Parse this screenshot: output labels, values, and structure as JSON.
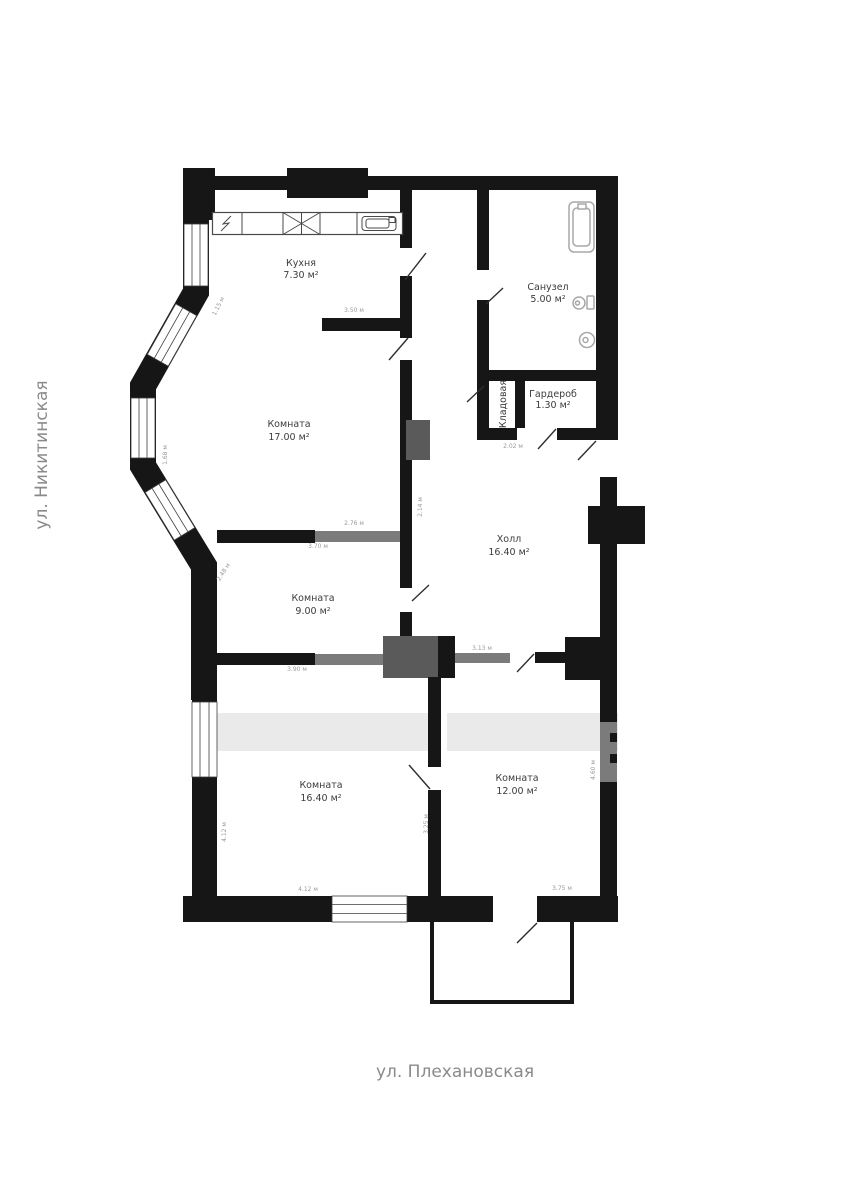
{
  "plan": {
    "streets": {
      "left": "ул. Никитинская",
      "bottom": "ул. Плехановская"
    },
    "rooms": {
      "kitchen": {
        "name": "Кухня",
        "area": "7.30 м²"
      },
      "bathroom": {
        "name": "Санузел",
        "area": "5.00 м²"
      },
      "wardrobe": {
        "name": "Гардероб",
        "area": "1.30 м²"
      },
      "storage": {
        "name": "Кладовая"
      },
      "room17": {
        "name": "Комната",
        "area": "17.00 м²"
      },
      "hall": {
        "name": "Холл",
        "area": "16.40 м²"
      },
      "room9": {
        "name": "Комната",
        "area": "9.00 м²"
      },
      "room16": {
        "name": "Комната",
        "area": "16.40 м²"
      },
      "room12": {
        "name": "Комната",
        "area": "12.00 м²"
      }
    },
    "dimensions": [
      "1.15 м",
      "3.50 м",
      "1.68 м",
      "2.02 м",
      "2.76 м",
      "3.70 м",
      "2.14 м",
      "2.48 м",
      "3.90 м",
      "3.13 м",
      "4.60 м",
      "4.12 м",
      "4.12 м",
      "3.25 м",
      "3.75 м"
    ],
    "colors": {
      "wall": "#161616",
      "partition": "#7b7b7b",
      "fixture": "#a8a8a8",
      "label_text": "#3c3c3c",
      "dim_text": "#9a9a9a",
      "street_text": "#8a8a8a"
    }
  }
}
